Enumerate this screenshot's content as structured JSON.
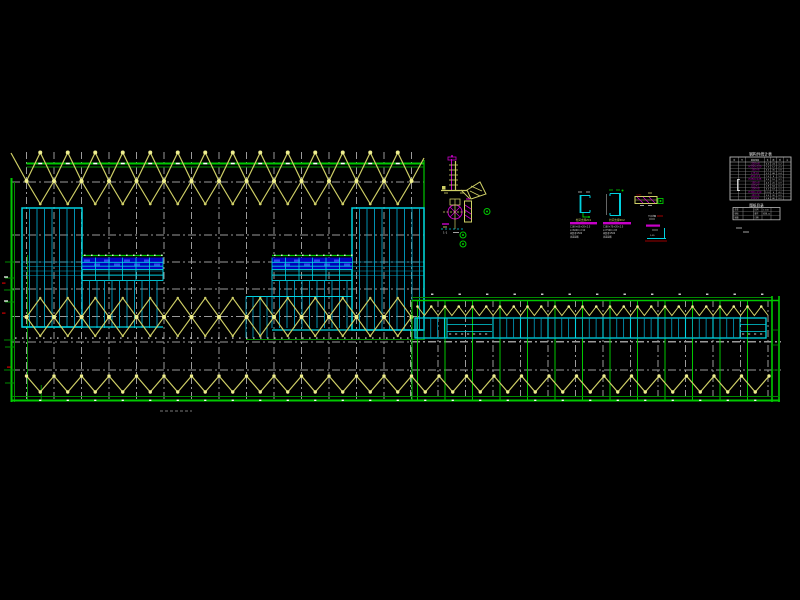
{
  "app": {
    "view_label": "structural steel roof bracing plan"
  },
  "colors": {
    "bg": "#000000",
    "green": "#00c800",
    "green_dark": "#008c00",
    "yellow": "#cfcf66",
    "yellow_bright": "#efef8f",
    "cyan": "#00d2e0",
    "cyan_dim": "#00a0c4",
    "blue": "#0000bc",
    "blue_bright": "#3344f0",
    "gray": "#9a9a9a",
    "white": "#f0f0f0",
    "magenta": "#c800c8",
    "red": "#d00000",
    "table_line": "#b8b8b8"
  },
  "drawing": {
    "grid_spacing": 27.5,
    "left_building": {
      "x_start": 26.5,
      "x_end": 424,
      "bays": 14,
      "top_band": {
        "chord1": 163.5,
        "chord2": 167,
        "peak": 152.5,
        "cross": 181,
        "dip": 204
      },
      "mid_band": {
        "top": 298,
        "cross": 317,
        "bot": 336,
        "dot_row": 337.5
      },
      "h_gridlines": [
        182,
        235,
        262,
        289,
        316.5
      ]
    },
    "right_building": {
      "x_start": 412,
      "x_end": 780,
      "col_start": 417.5,
      "cols": 13,
      "green_top": 300.5,
      "wave_top": 306.5,
      "wave_bot": 315.5,
      "strip": {
        "x1": 415,
        "x2": 766,
        "y1": 318,
        "y2": 338,
        "plain_sections": [
          [
            447,
            492
          ],
          [
            740,
            766
          ]
        ]
      },
      "dash_y": 341.5
    },
    "global_band": {
      "zig_top": 376,
      "zig_bot": 392,
      "x1": 26.5,
      "x2": 770,
      "green1": 396.5,
      "green2": 400.5,
      "h_gridlines": [
        342,
        370
      ]
    }
  },
  "details": {
    "a_label": "1-1",
    "b1_title": "柱间支撑ZC1",
    "b1_lines": [
      "C160×60×20×2.5",
      "L=6000 n=12",
      "间距@1500",
      "含连接板"
    ],
    "b2_title": "柱间支撑ZC2",
    "b2_lines": [
      "C180×70×20×2.5",
      "L=7500 n=8",
      "间距@1500",
      "含连接板"
    ],
    "b3_label": "Q235",
    "b4_label": "节点详图",
    "b4_note": "1:25"
  },
  "title_block": {
    "main_title": "钢构件统计表",
    "headers": [
      "序",
      "号",
      "截面规格",
      "长",
      "数",
      "重",
      "注"
    ],
    "main_rows": [
      {
        "spec": "-220×8",
        "len": "6.0",
        "qty": "24",
        "wt": "1.2"
      },
      {
        "spec": "H200×100",
        "len": "7.5",
        "qty": "12",
        "wt": "2.3"
      },
      {
        "spec": "-160×6",
        "len": "6.0",
        "qty": "36",
        "wt": "0.8"
      },
      {
        "spec": "L75×6",
        "len": "3.2",
        "qty": "48",
        "wt": "0.4"
      },
      {
        "spec": "-250×10",
        "len": "7.5",
        "qty": "8",
        "wt": "1.9"
      },
      {
        "spec": "H250×125",
        "len": "9.0",
        "qty": "16",
        "wt": "3.1"
      },
      {
        "spec": "-180×8",
        "len": "4.5",
        "qty": "20",
        "wt": "0.9"
      },
      {
        "spec": "L63×5",
        "len": "2.8",
        "qty": "64",
        "wt": "0.3"
      },
      {
        "spec": "-200×8",
        "len": "6.0",
        "qty": "18",
        "wt": "1.1"
      },
      {
        "spec": "H300×150",
        "len": "12.0",
        "qty": "6",
        "wt": "4.2"
      },
      {
        "spec": "-140×6",
        "len": "3.5",
        "qty": "30",
        "wt": "0.5"
      },
      {
        "spec": "L50×5",
        "len": "2.4",
        "qty": "40",
        "wt": "0.2"
      }
    ],
    "section_symbol": "[",
    "sub_title": "图纸目录",
    "sub_rows": [
      [
        "会签",
        "",
        "比例",
        "1:100"
      ],
      [
        "审核",
        "",
        "图号",
        "结施-12"
      ],
      [
        "制图",
        "",
        "日期",
        ""
      ]
    ]
  }
}
